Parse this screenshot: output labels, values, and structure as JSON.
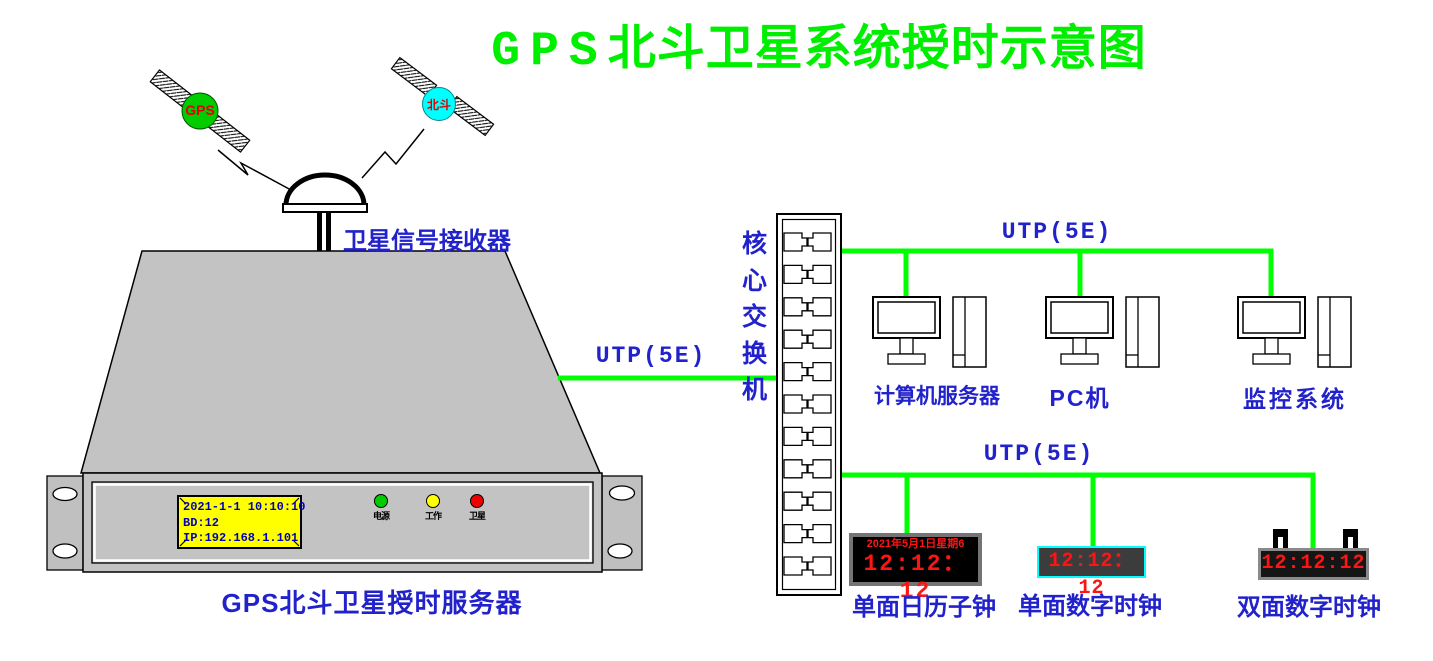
{
  "title": {
    "prefix": "GPS",
    "suffix": "北斗卫星系统授时示意图"
  },
  "satellites": {
    "gps": {
      "label": "GPS"
    },
    "beidou": {
      "label": "北斗"
    }
  },
  "receiver": {
    "label": "卫星信号接收器"
  },
  "server": {
    "label": "GPS北斗卫星授时服务器",
    "lcd": {
      "line1": "2021-1-1 10:10:10",
      "line2": "BD:12",
      "line3": "IP:192.168.1.101"
    },
    "leds": {
      "power": "电源",
      "work": "工作",
      "satellite": "卫星"
    }
  },
  "links": {
    "server_to_switch": "UTP(5E)",
    "computers_bus": "UTP(5E)",
    "clocks_bus": "UTP(5E)"
  },
  "switch": {
    "label": "核心交换机",
    "port_rows": 11
  },
  "computers": {
    "server": "计算机服务器",
    "pc": "PC机",
    "monitor": "监控系统"
  },
  "clocks": {
    "calendar": {
      "label": "单面日历子钟",
      "date": "2021年5月1日星期6",
      "time": "12:12： 12"
    },
    "single": {
      "label": "单面数字时钟",
      "time": "12:12： 12"
    },
    "dual": {
      "label": "双面数字时钟",
      "time": "12:12:12"
    }
  },
  "colors": {
    "title_green": "#00ee00",
    "cable_green": "#00ff00",
    "label_blue": "#2222cc",
    "clock_red": "#ff1414",
    "lcd_yellow": "#ffff00",
    "lcd_text_blue": "#0000b6",
    "gps_ball": "#00cc00",
    "beidou_ball": "#00ffff",
    "chassis_gray": "#c3c3c3"
  }
}
